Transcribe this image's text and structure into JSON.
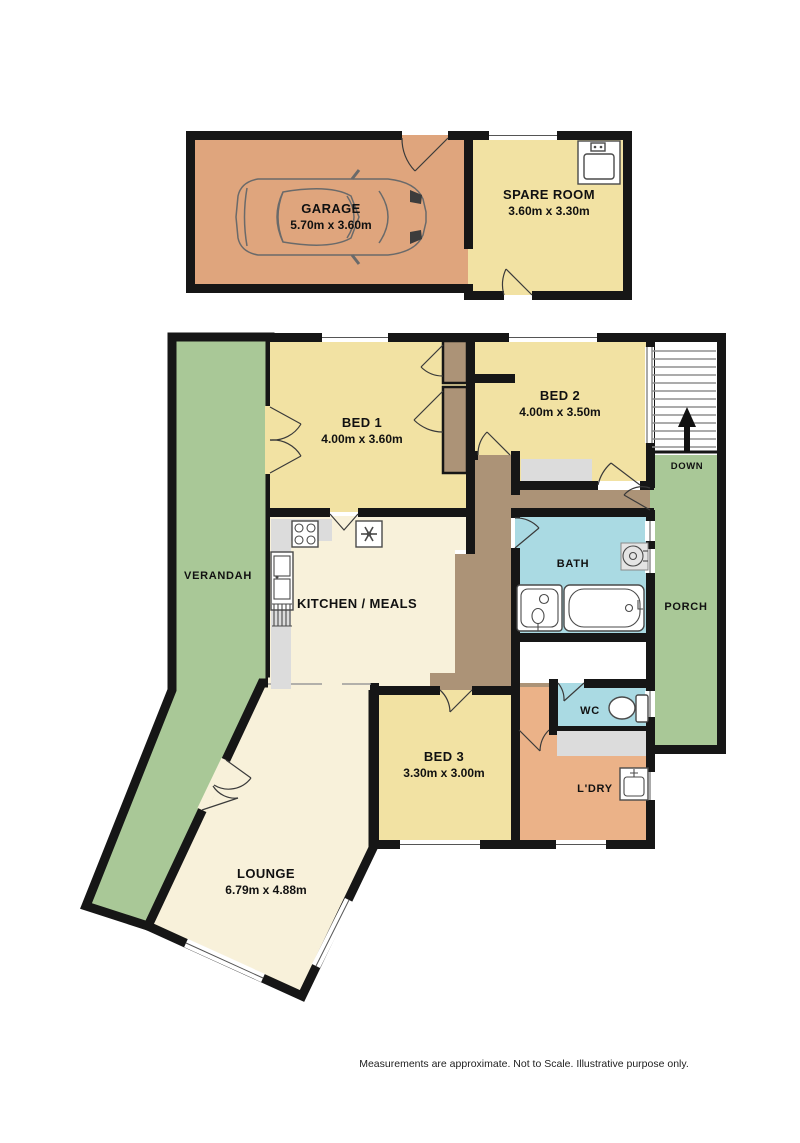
{
  "plan": {
    "rooms": {
      "garage": {
        "name": "GARAGE",
        "dims": "5.70m x 3.60m"
      },
      "spare_room": {
        "name": "SPARE ROOM",
        "dims": "3.60m x 3.30m"
      },
      "bed1": {
        "name": "BED 1",
        "dims": "4.00m x 3.60m"
      },
      "bed2": {
        "name": "BED 2",
        "dims": "4.00m x 3.50m"
      },
      "bed3": {
        "name": "BED 3",
        "dims": "3.30m x 3.00m"
      },
      "lounge": {
        "name": "LOUNGE",
        "dims": "6.79m x 4.88m"
      },
      "kitchen": {
        "name": "KITCHEN / MEALS"
      },
      "bath": {
        "name": "BATH"
      },
      "wc": {
        "name": "WC"
      },
      "laundry": {
        "name": "L'DRY"
      },
      "verandah": {
        "name": "VERANDAH"
      },
      "porch": {
        "name": "PORCH"
      }
    },
    "stairs": {
      "label": "DOWN",
      "direction_icon": "up-arrow"
    },
    "fixture_icons": [
      "car-icon",
      "sink-icon",
      "stove-icon",
      "fan-icon",
      "kitchen-sink-icon",
      "vanity-icon",
      "bathtub-icon",
      "basin-icon",
      "toilet-icon",
      "trough-icon",
      "up-arrow-icon"
    ],
    "colors": {
      "wall": "#161616",
      "garage": "#DFA57D",
      "bedroom": "#F2E2A3",
      "living": "#F8F1DA",
      "outdoor": "#A9C897",
      "wet": "#AADAE3",
      "laundry": "#EBB288",
      "hall": "#AC9377",
      "counter": "#DCDCDC"
    },
    "footer": {
      "disclaimer": "Measurements are approximate.  Not to Scale.  Illustrative purpose only."
    }
  }
}
